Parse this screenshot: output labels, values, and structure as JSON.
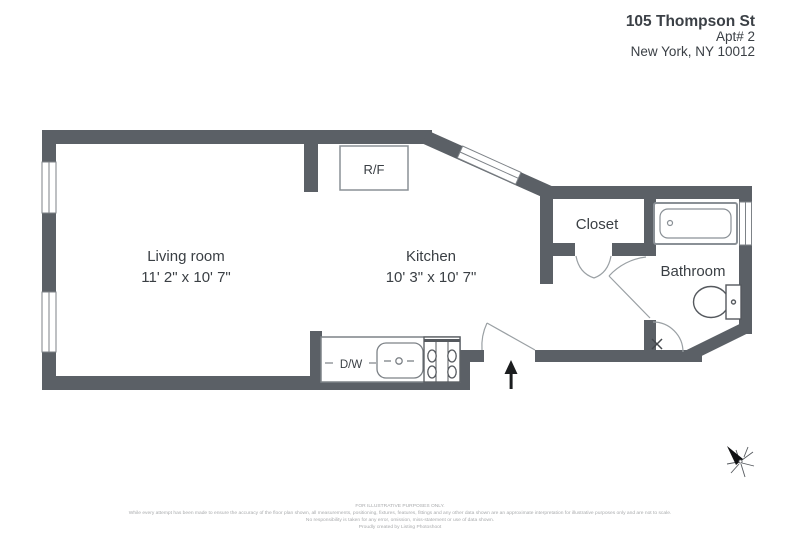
{
  "header": {
    "address_line1": "105 Thompson St",
    "address_line2": "Apt# 2",
    "address_line3": "New York, NY 10012"
  },
  "rooms": {
    "living_room": {
      "name": "Living room",
      "dimensions": "11' 2\" x 10' 7\""
    },
    "kitchen": {
      "name": "Kitchen",
      "dimensions": "10' 3\" x 10' 7\""
    },
    "closet": {
      "name": "Closet"
    },
    "bathroom": {
      "name": "Bathroom"
    }
  },
  "fixtures": {
    "refrigerator_label": "R/F",
    "dishwasher_label": "D/W"
  },
  "icons": {
    "entry_arrow": "north-entry-arrow",
    "compass": "compass-star",
    "windows": "double-line-window",
    "doors": "door-swing-arc"
  },
  "colors": {
    "wall": "#5b6066",
    "text": "#3a3f44",
    "fixture_line": "#8a9096",
    "door_line": "#9aa0a4",
    "footer_text": "#a9abad"
  },
  "footer": {
    "line1": "FOR ILLUSTRATIVE PURPOSES ONLY.",
    "line2": "While every attempt has been made to ensure the accuracy of the floor plan shown, all measurements, positioning, fixtures, features, fittings and any other data shown are an approximate interpretation for illustrative purposes only and are not to scale.",
    "line3": "No responsibility is taken for any error, omission, miss-statement or use of data shown.",
    "line4": "Proudly created by Listing Photoshoot"
  }
}
